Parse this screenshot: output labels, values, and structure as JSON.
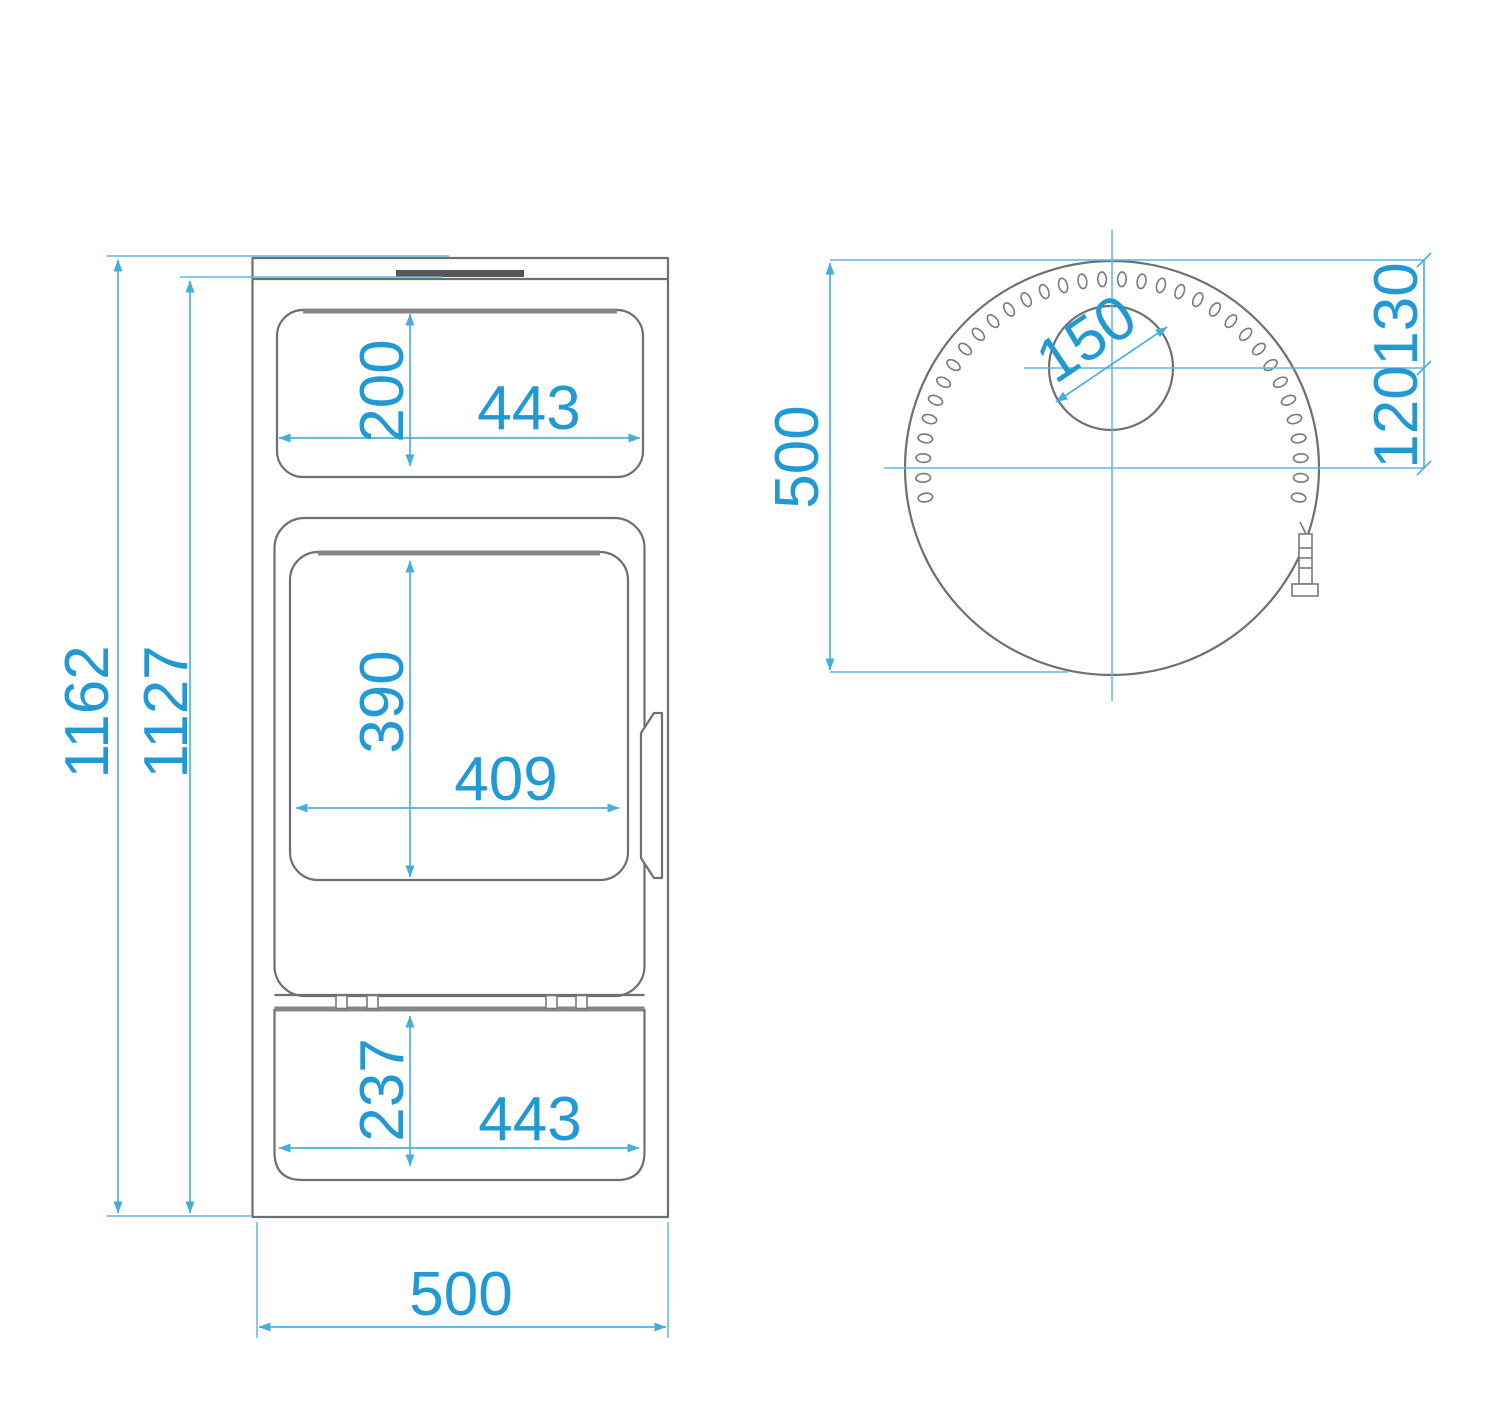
{
  "drawing": {
    "title": "stove-dimension-drawing",
    "views": {
      "front": "front-view",
      "top": "top-view"
    },
    "colors": {
      "dimension_text": "#2199d4",
      "dimension_line": "#4fb0dc",
      "outline_gray": "#6d6f72",
      "dark_accent": "#56575a",
      "background": "#ffffff"
    }
  },
  "dims": {
    "overall_height": "1162",
    "body_height": "1127",
    "top_window_height": "200",
    "top_window_width": "443",
    "door_glass_height": "390",
    "door_glass_width": "409",
    "drawer_height": "237",
    "drawer_width": "443",
    "overall_width": "500",
    "top_depth": "500",
    "flue_diameter": "150",
    "flue_center_from_edge": "130",
    "flue_center_from_middle": "120"
  }
}
